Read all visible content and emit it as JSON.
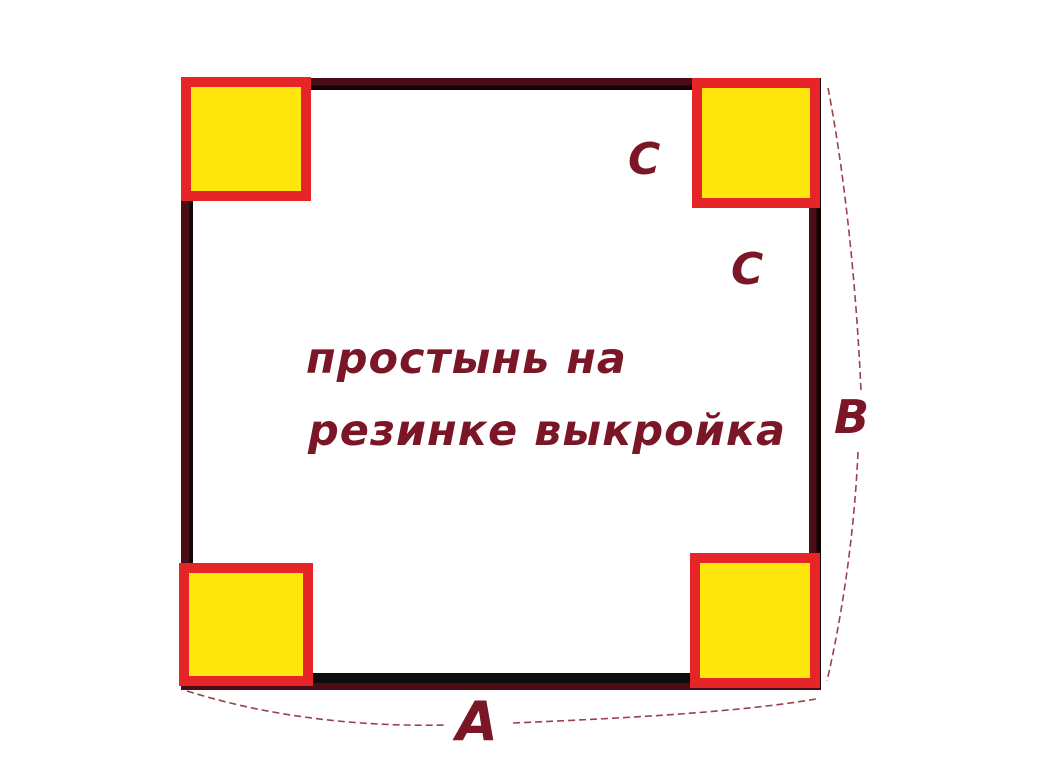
{
  "figure": {
    "caption": {
      "line1": "простынь на",
      "line2": "резинке выкройка"
    },
    "labels": {
      "a": "A",
      "b": "B",
      "c": "C"
    },
    "colors": {
      "background": "#ffffff",
      "outline_maroon": "#4a0c15",
      "outline_black": "#140305",
      "corner_fill_yellow": "#ffe70d",
      "corner_border_red": "#e52528",
      "lettering_maroon": "#7b1627",
      "dimension_curve": "#9b414b"
    }
  }
}
